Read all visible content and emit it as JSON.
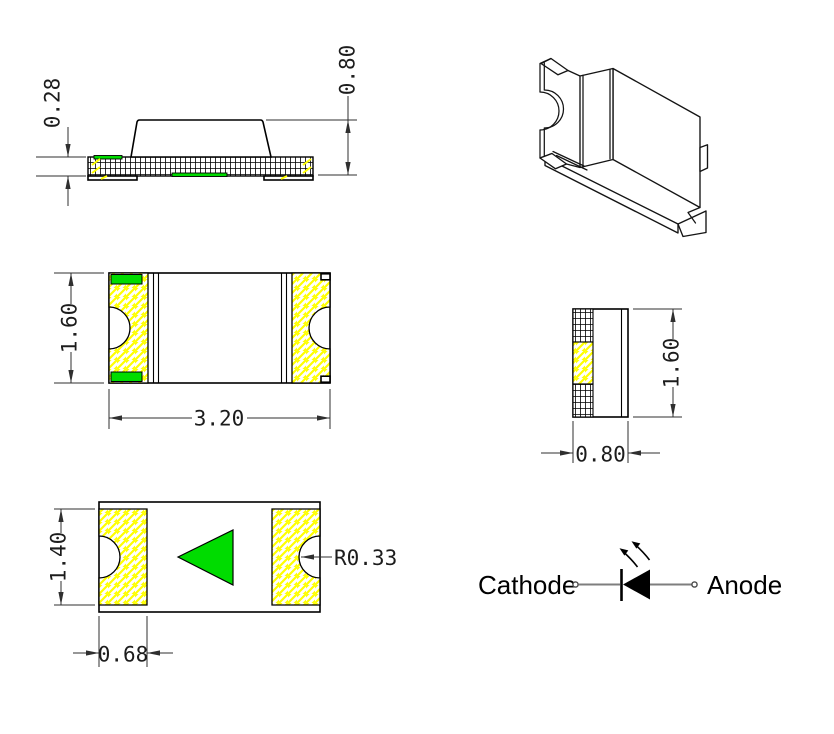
{
  "drawing": {
    "description": "SMD chip LED package outline drawing with five views and polarity schematic",
    "side_view": {
      "substrate_thickness": "0.28",
      "overall_height": "0.80"
    },
    "top_view": {
      "body_width": "1.60",
      "body_length": "3.20"
    },
    "end_view": {
      "body_height": "1.60",
      "body_thickness": "0.80"
    },
    "bottom_view": {
      "pad_span": "1.40",
      "pad_width": "0.68",
      "castellation_radius": "R0.33"
    },
    "schematic": {
      "cathode_label": "Cathode",
      "anode_label": "Anode"
    }
  },
  "colors": {
    "polarity_green": "#00dc00",
    "hatch_yellow": "#ffff00",
    "outline_black": "#000000",
    "dimension_gray": "#2f2f2f",
    "wire_gray": "#7e7e7e",
    "background": "#ffffff"
  }
}
